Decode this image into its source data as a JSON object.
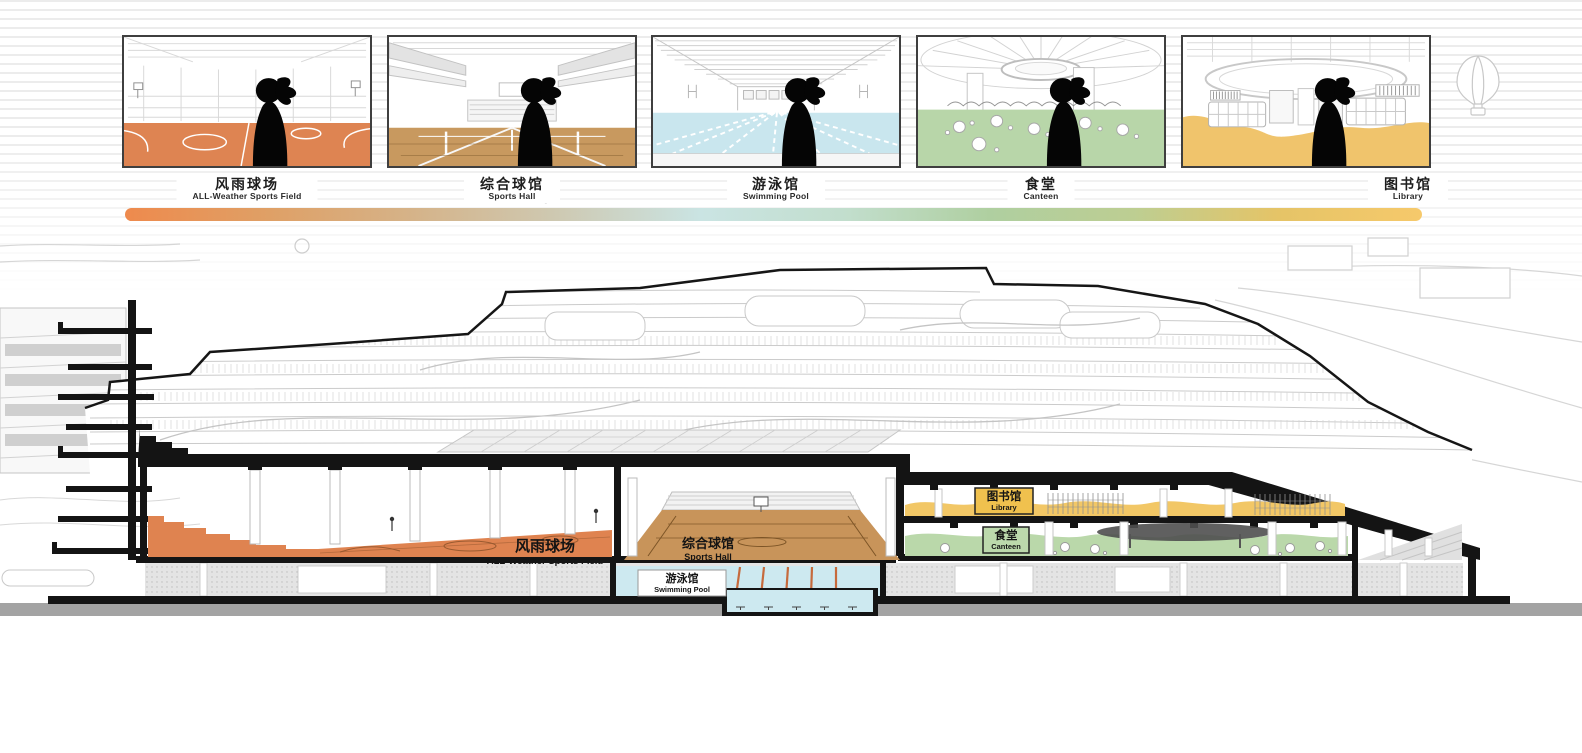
{
  "panels": [
    {
      "name_cn": "风雨球场",
      "name_en": "ALL-Weather Sports Field",
      "floor": "#DE8452"
    },
    {
      "name_cn": "综合球馆",
      "name_en": "Sports Hall",
      "floor": "#C8995F"
    },
    {
      "name_cn": "游泳馆",
      "name_en": "Swimming Pool",
      "floor": "#C9E6EE"
    },
    {
      "name_cn": "食堂",
      "name_en": "Canteen",
      "floor": "#B8D6A9"
    },
    {
      "name_cn": "图书馆",
      "name_en": "Library",
      "floor": "#F0C46C"
    }
  ],
  "gradient_bar": {
    "colors": [
      "#EE8A4D",
      "#DFA066",
      "#D5B389",
      "#CEC9B2",
      "#CAE4E3",
      "#C2DECD",
      "#AFCFA0",
      "#BDCE92",
      "#E5C467",
      "#F6C96B"
    ]
  },
  "section": {
    "sports_field": {
      "cn": "风雨球场",
      "en": "ALL-Weather Sports Field",
      "color": "#DF8350"
    },
    "sports_hall": {
      "cn": "综合球馆",
      "en": "Sports Hall",
      "color": "#C8945A"
    },
    "swimming_pool": {
      "cn": "游泳馆",
      "en": "Swimming Pool",
      "color": "#CDE9F0"
    },
    "library": {
      "cn": "图书馆",
      "en": "Library",
      "color": "#F2C766"
    },
    "canteen": {
      "cn": "食堂",
      "en": "Canteen",
      "color": "#BAD8AA"
    }
  },
  "colors": {
    "cut_black": "#141414",
    "ground_gray": "#A3A3A3",
    "basement_gray": "#E4E4E4"
  }
}
